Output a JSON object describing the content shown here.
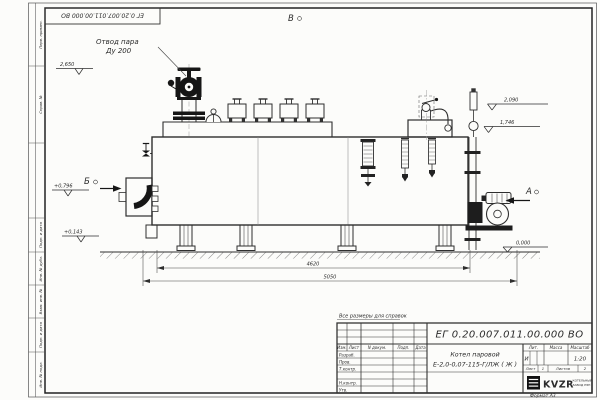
{
  "frame": {
    "doc_number_top": "ЕГ 0.20.007.011.00.000  ВО",
    "format_note": "Формат А3"
  },
  "margin_labels": [
    "Перв. примен.",
    "Справ. №",
    "Подп. и дата",
    "Инв. № дубл.",
    "Взам. инв. №",
    "Подп. и дата",
    "Инв. № подл."
  ],
  "note": "Все размеры для справок",
  "title_block": {
    "doc_number": "ЕГ 0.20.007.011.00.000  ВО",
    "product_name_line1": "Котел паровой",
    "product_name_line2": "Е-2,0-0,07-115-Г/ЛЖ ( Ж )",
    "header_izm": "Изм.",
    "header_list": "Лист",
    "header_ndoc": "N докум.",
    "header_podp": "Подп.",
    "header_data": "Дата",
    "row_razrab": "Разраб.",
    "row_prov": "Пров.",
    "row_tkontr": "Т.контр.",
    "row_nkontr": "Н.контр.",
    "row_utv": "Утв.",
    "lit_header": "Лит.",
    "mass_header": "Масса",
    "scale_header": "Масштаб",
    "lit_value": "И",
    "scale_value": "1:20",
    "sheet_label": "Лист",
    "sheet_value": "1",
    "sheets_label": "Листов",
    "sheets_value": "2",
    "logo_text": "KVZR",
    "logo_caption_line1": "КОТЕЛЬНЫЙ",
    "logo_caption_line2": "ЗАВОД РЭП"
  },
  "annotations": {
    "steam_outlet_line1": "Отвод пара",
    "steam_outlet_line2": "Ду 200",
    "view_top": "В",
    "view_left": "Б",
    "view_right": "А",
    "elev_steam": "2,650",
    "elev_burner": "+0,796",
    "elev_low": "+0,143",
    "elev_right_top": "2,090",
    "elev_right_mid": "1,746",
    "elev_ground": "0,000",
    "dim_inner": "4620",
    "dim_overall": "5050"
  },
  "colors": {
    "line": "#2e2e2e",
    "dark_fill": "#161616",
    "paper": "#fcfcfa"
  }
}
